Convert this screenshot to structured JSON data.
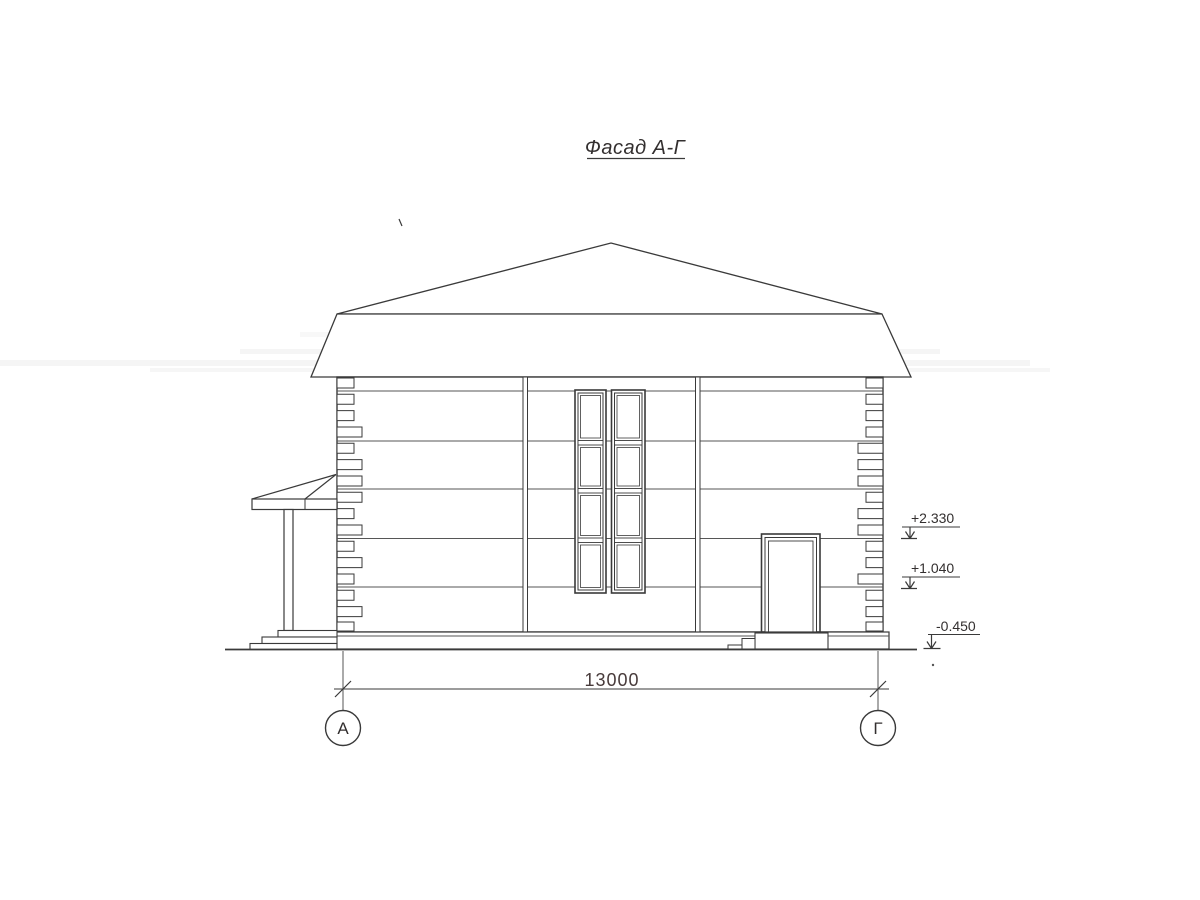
{
  "title": {
    "text": "Фасад А-Г"
  },
  "dimension": {
    "label": "13000"
  },
  "levels": {
    "eave": "+2.330",
    "mid": "+1.040",
    "ground": "-0.450"
  },
  "axes": {
    "left": "А",
    "right": "Г"
  },
  "colors": {
    "ink": "#3a3a3a",
    "paper": "#ffffff"
  }
}
